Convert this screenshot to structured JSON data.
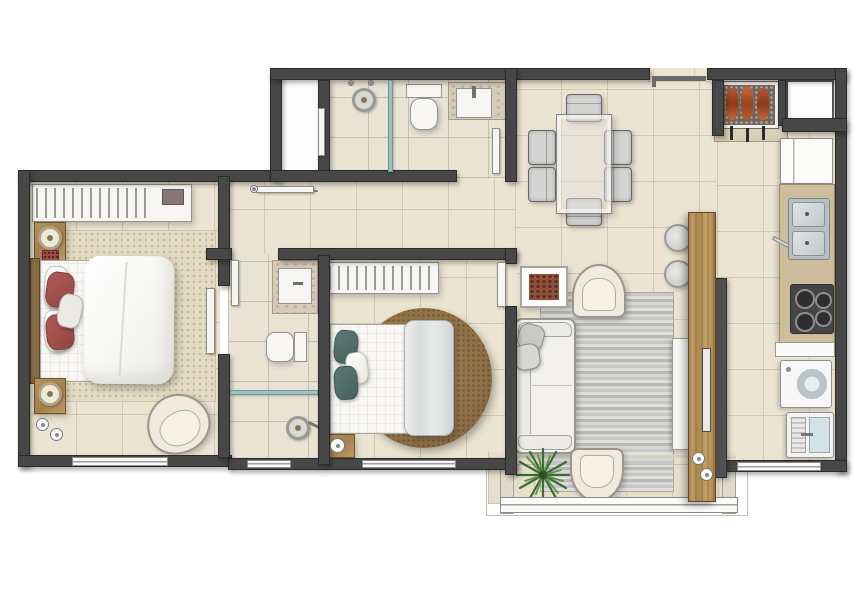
{
  "document": {
    "type": "apartment-floor-plan",
    "style": "top-down color rendering",
    "visible_text": "none"
  },
  "palette": {
    "background": "#ffffff",
    "wall": "#474747",
    "floor_tile": "#ece4d2",
    "bathroom_tile": "#e9e3d4",
    "wood_panel": "#b5935f",
    "kitchen_counter": "#ccbd9d",
    "rug_master": "#e4dac2",
    "rug_round_brown": "#8f7148",
    "rug_living_gray": "#c7c7c5",
    "pillow_red": "#a25550",
    "pillow_teal": "#50716b",
    "plant_green": "#3b6c34",
    "shower_glass": "#9fc0bc",
    "barbecue_meat": "#a8502c"
  },
  "rooms": [
    {
      "name": "master-bedroom",
      "furniture": [
        "wardrobe-with-hangers",
        "double-bed",
        "red-pillows",
        "nightstand-with-lamp",
        "nightstand-with-lamp",
        "area-rug",
        "armchair",
        "window"
      ]
    },
    {
      "name": "bathroom-1",
      "furniture": [
        "shower-head",
        "glass-partition",
        "toilet",
        "sink-vanity",
        "door"
      ]
    },
    {
      "name": "closet",
      "furniture": [
        "sliding-door"
      ]
    },
    {
      "name": "hallway",
      "furniture": []
    },
    {
      "name": "bathroom-2",
      "furniture": [
        "sink-vanity",
        "toilet",
        "glass-partition",
        "shower-head",
        "window",
        "door"
      ]
    },
    {
      "name": "bedroom-2",
      "furniture": [
        "wardrobe-with-hangers",
        "double-bed",
        "teal-pillows",
        "folded-blanket",
        "round-rug",
        "nightstand",
        "window",
        "door"
      ]
    },
    {
      "name": "dining-room",
      "furniture": [
        "glass-table",
        "upholstered-chair-x6",
        "entry-door"
      ]
    },
    {
      "name": "living-room",
      "furniture": [
        "sofa",
        "gray-pillows",
        "striped-rug",
        "armchair",
        "armchair",
        "framed-picture",
        "round-pouf",
        "round-pouf",
        "wood-tv-panel",
        "tv",
        "tv-cabinet"
      ]
    },
    {
      "name": "balcony",
      "furniture": [
        "potted-plant",
        "armchair",
        "glass-railing"
      ]
    },
    {
      "name": "kitchen-laundry",
      "furniture": [
        "barbecue-grill",
        "skewers",
        "duct-shaft",
        "refrigerator",
        "counter",
        "double-sink",
        "cooktop-4-burners",
        "bench",
        "washing-machine",
        "laundry-tank",
        "window"
      ]
    }
  ]
}
